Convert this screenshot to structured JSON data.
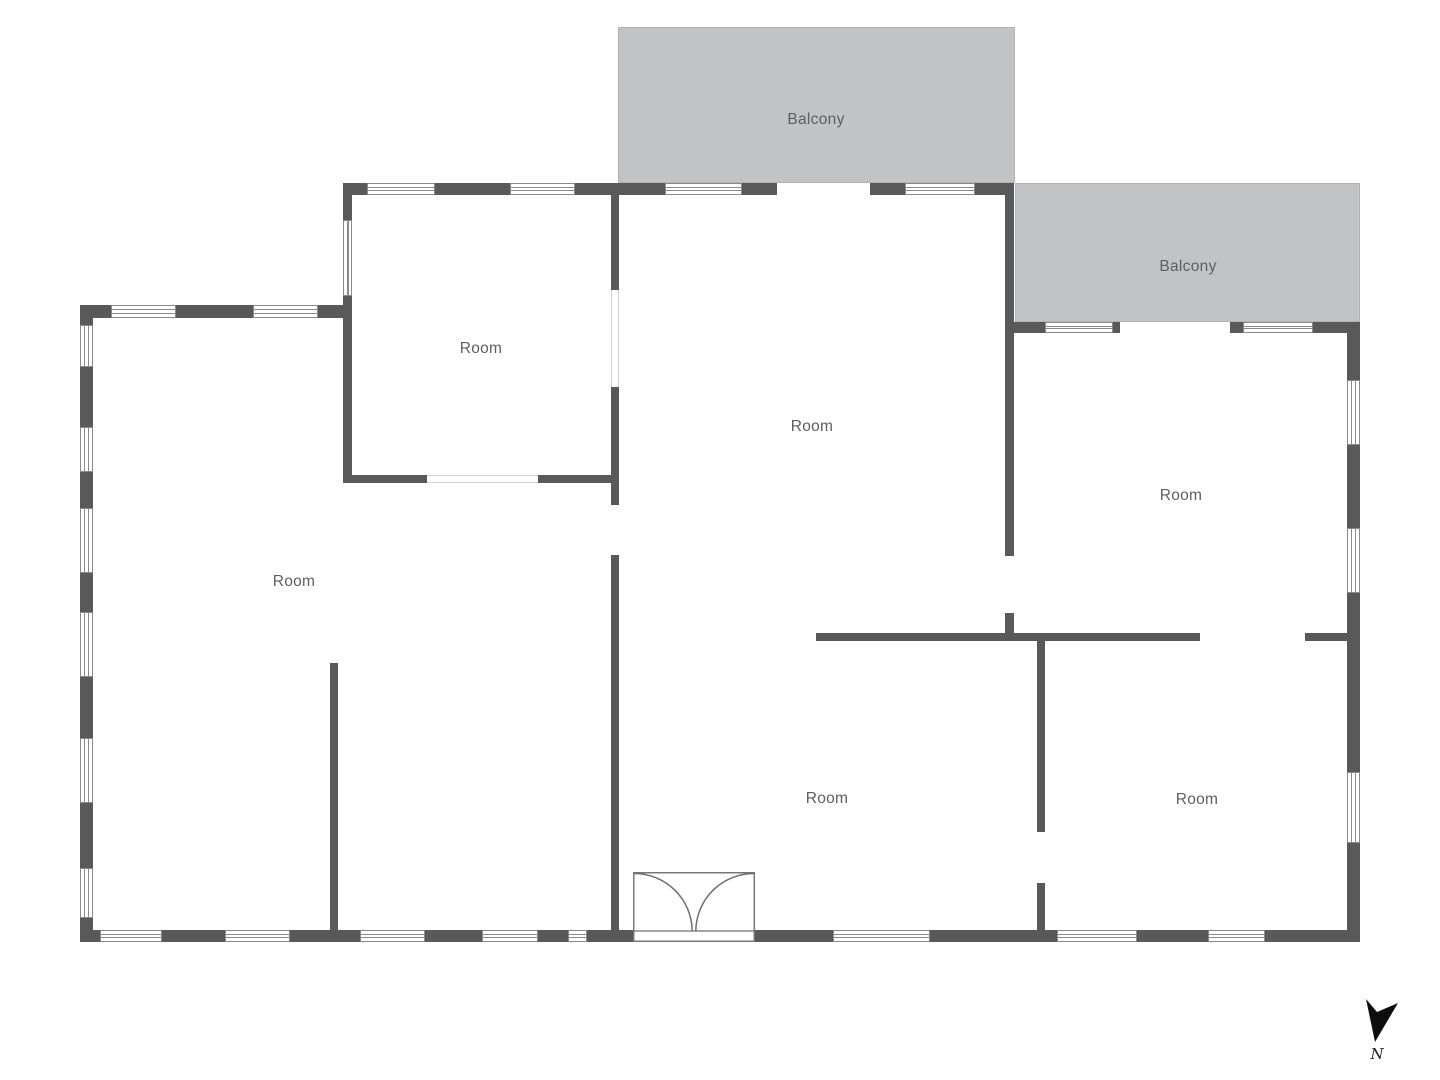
{
  "plan": {
    "colors": {
      "wall": "#595959",
      "balcony_fill": "#c2c3c4",
      "window_border": "#8a8a8a",
      "label_text": "#5c5f62",
      "north_arrow": "#0e0e0e",
      "door_stroke": "#6f6f6f"
    },
    "balconies": [
      {
        "label": "Balcony",
        "rect": [
          618,
          27,
          397,
          156
        ],
        "label_cx": 816,
        "label_cy": 120
      },
      {
        "label": "Balcony",
        "rect": [
          1015,
          183,
          345,
          139
        ],
        "label_cx": 1188,
        "label_cy": 267
      }
    ],
    "room_labels": [
      {
        "text": "Room",
        "cx": 481,
        "cy": 349
      },
      {
        "text": "Room",
        "cx": 812,
        "cy": 427
      },
      {
        "text": "Room",
        "cx": 294,
        "cy": 582
      },
      {
        "text": "Room",
        "cx": 1181,
        "cy": 496
      },
      {
        "text": "Room",
        "cx": 827,
        "cy": 799
      },
      {
        "text": "Room",
        "cx": 1197,
        "cy": 800
      }
    ],
    "walls": [
      [
        80,
        305,
        13,
        20
      ],
      [
        80,
        367,
        13,
        60
      ],
      [
        80,
        472,
        13,
        36
      ],
      [
        80,
        573,
        13,
        39
      ],
      [
        80,
        677,
        13,
        61
      ],
      [
        80,
        803,
        13,
        65
      ],
      [
        80,
        918,
        13,
        24
      ],
      [
        80,
        305,
        31,
        13
      ],
      [
        176,
        305,
        77,
        13
      ],
      [
        318,
        305,
        34,
        13
      ],
      [
        343,
        183,
        9,
        37
      ],
      [
        343,
        296,
        9,
        187
      ],
      [
        343,
        183,
        24,
        12
      ],
      [
        435,
        183,
        75,
        12
      ],
      [
        575,
        183,
        90,
        12
      ],
      [
        742,
        183,
        35,
        12
      ],
      [
        870,
        183,
        35,
        12
      ],
      [
        975,
        183,
        39,
        12
      ],
      [
        1005,
        195,
        9,
        361
      ],
      [
        1005,
        613,
        9,
        28
      ],
      [
        1014,
        322,
        31,
        11
      ],
      [
        1113,
        322,
        7,
        11
      ],
      [
        1230,
        322,
        13,
        11
      ],
      [
        1313,
        322,
        47,
        11
      ],
      [
        1347,
        322,
        13,
        58
      ],
      [
        1347,
        445,
        13,
        83
      ],
      [
        1347,
        593,
        13,
        179
      ],
      [
        1347,
        843,
        13,
        99
      ],
      [
        80,
        930,
        20,
        12
      ],
      [
        162,
        930,
        63,
        12
      ],
      [
        290,
        930,
        70,
        12
      ],
      [
        425,
        930,
        57,
        12
      ],
      [
        538,
        930,
        30,
        12
      ],
      [
        587,
        930,
        46,
        12
      ],
      [
        755,
        930,
        78,
        12
      ],
      [
        930,
        930,
        127,
        12
      ],
      [
        1137,
        930,
        71,
        12
      ],
      [
        1265,
        930,
        95,
        12
      ],
      [
        611,
        195,
        8,
        95
      ],
      [
        611,
        387,
        8,
        118
      ],
      [
        611,
        555,
        8,
        375
      ],
      [
        343,
        475,
        84,
        8
      ],
      [
        538,
        475,
        81,
        8
      ],
      [
        330,
        663,
        8,
        267
      ],
      [
        816,
        633,
        384,
        8
      ],
      [
        1305,
        633,
        45,
        8
      ],
      [
        1037,
        641,
        8,
        191
      ],
      [
        1037,
        883,
        8,
        47
      ]
    ],
    "windows": [
      [
        111,
        305,
        65,
        13
      ],
      [
        253,
        305,
        65,
        13
      ],
      [
        367,
        183,
        68,
        12
      ],
      [
        510,
        183,
        65,
        12
      ],
      [
        665,
        183,
        77,
        12
      ],
      [
        905,
        183,
        70,
        12
      ],
      [
        1045,
        322,
        68,
        11
      ],
      [
        1243,
        322,
        70,
        11
      ],
      [
        100,
        930,
        62,
        12
      ],
      [
        225,
        930,
        65,
        12
      ],
      [
        360,
        930,
        65,
        12
      ],
      [
        482,
        930,
        56,
        12
      ],
      [
        568,
        930,
        19,
        12
      ],
      [
        833,
        930,
        97,
        12
      ],
      [
        1057,
        930,
        80,
        12
      ],
      [
        1208,
        930,
        57,
        12
      ],
      [
        80,
        325,
        13,
        42
      ],
      [
        80,
        427,
        13,
        45
      ],
      [
        80,
        508,
        13,
        65
      ],
      [
        80,
        612,
        13,
        65
      ],
      [
        80,
        738,
        13,
        65
      ],
      [
        80,
        868,
        13,
        50
      ],
      [
        343,
        220,
        9,
        76
      ],
      [
        1347,
        380,
        13,
        65
      ],
      [
        1347,
        528,
        13,
        65
      ],
      [
        1347,
        772,
        13,
        71
      ]
    ],
    "openings": [
      [
        611,
        290,
        8,
        97
      ],
      [
        427,
        475,
        111,
        8
      ]
    ],
    "door": {
      "x": 633,
      "y": 872,
      "w": 122,
      "h": 70,
      "sill_y": 59,
      "leaf": 58
    },
    "north": {
      "x": 1362,
      "y": 996,
      "w": 40,
      "h": 48,
      "points": "4,3 15,16 36,7 13,46",
      "label": "N",
      "label_cx": 1377,
      "label_cy": 1045
    }
  }
}
